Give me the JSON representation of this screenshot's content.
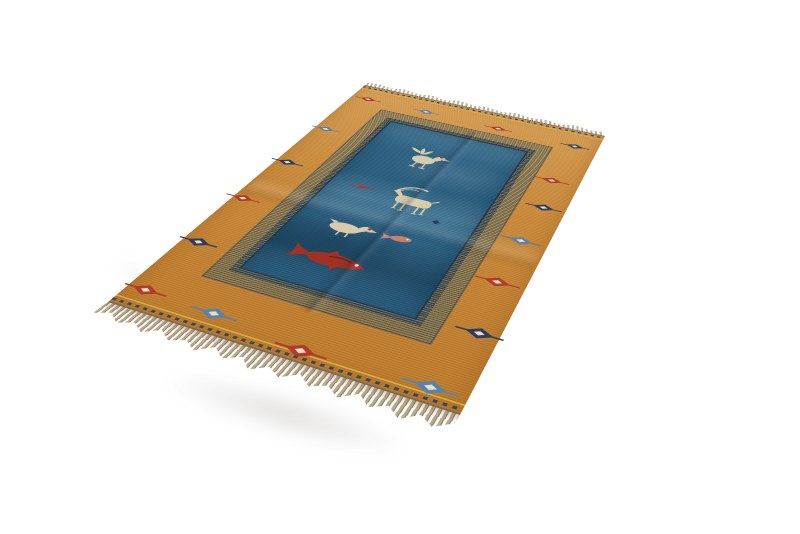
{
  "scene": {
    "type": "product-photo",
    "subject": "Handwoven wool kilim area rug with fringe, photographed at a perspective angle on a seamless white background",
    "background_color": "#ffffff"
  },
  "rug": {
    "description": "Orange-tan bordered kilim with a steel-blue central field framed by a navy-and-gold pinstriped band; pictorial animal motifs in the field and small diamond eye motifs scattered in the border; natural tan fringe on both short ends",
    "colors": {
      "background": "#ffffff",
      "border_orange_light": "#d9a258",
      "border_orange": "#cb8c3c",
      "border_orange_deep": "#bd7c2c",
      "band_gold": "#b6924e",
      "band_navy": "#2c4868",
      "field_blue": "#33688a",
      "field_blue_light": "#4d809d",
      "field_blue_dark": "#234e6a",
      "beige": "#d7cbab",
      "red": "#b23a2c",
      "slate": "#5b82a8",
      "navy": "#2b3c5e",
      "salmon": "#c5816c",
      "darkred": "#a23124",
      "fringe": "#b9a98c",
      "fringe_dark": "#93815f",
      "gold_line": "#d8ae45",
      "binding": "#7a6a52"
    },
    "border_motifs": [
      {
        "x": 25,
        "y": 42,
        "color": "red",
        "s": 0.9
      },
      {
        "x": 115,
        "y": 42,
        "color": "slate",
        "s": 0.9
      },
      {
        "x": 222,
        "y": 45,
        "color": "red",
        "s": 0.9
      },
      {
        "x": 330,
        "y": 48,
        "color": "navy",
        "s": 0.9
      },
      {
        "x": 326,
        "y": 148,
        "color": "red",
        "s": 1.0
      },
      {
        "x": 334,
        "y": 213,
        "color": "navy",
        "s": 1.0
      },
      {
        "x": 330,
        "y": 290,
        "color": "slate",
        "s": 1.05
      },
      {
        "x": 330,
        "y": 372,
        "color": "red",
        "s": 1.1
      },
      {
        "x": 340,
        "y": 455,
        "color": "navy",
        "s": 1.1
      },
      {
        "x": 325,
        "y": 540,
        "color": "slate",
        "s": 1.2
      },
      {
        "x": 200,
        "y": 545,
        "color": "red",
        "s": 1.2
      },
      {
        "x": 100,
        "y": 533,
        "color": "slate",
        "s": 1.15
      },
      {
        "x": 20,
        "y": 530,
        "color": "red",
        "s": 1.1
      },
      {
        "x": 18,
        "y": 440,
        "color": "navy",
        "s": 1.05
      },
      {
        "x": 12,
        "y": 345,
        "color": "red",
        "s": 1.0
      },
      {
        "x": 15,
        "y": 250,
        "color": "navy",
        "s": 1.0
      },
      {
        "x": 15,
        "y": 150,
        "color": "slate",
        "s": 0.95
      }
    ],
    "field_motifs": [
      {
        "name": "rooster",
        "x": 165,
        "y": 170,
        "color": "beige",
        "accent": "red"
      },
      {
        "name": "arrow_fish",
        "x": 125,
        "y": 263,
        "color": "red",
        "rot": -5
      },
      {
        "name": "ibex",
        "x": 196,
        "y": 268,
        "color": "beige"
      },
      {
        "name": "dot",
        "x": 232,
        "y": 296,
        "color": "navy"
      },
      {
        "name": "duck",
        "x": 150,
        "y": 349,
        "color": "beige",
        "accent": "red"
      },
      {
        "name": "fish_small",
        "x": 205,
        "y": 344,
        "color": "salmon",
        "rot": -8
      },
      {
        "name": "fish_large",
        "x": 155,
        "y": 409,
        "color": "darkred"
      }
    ]
  }
}
